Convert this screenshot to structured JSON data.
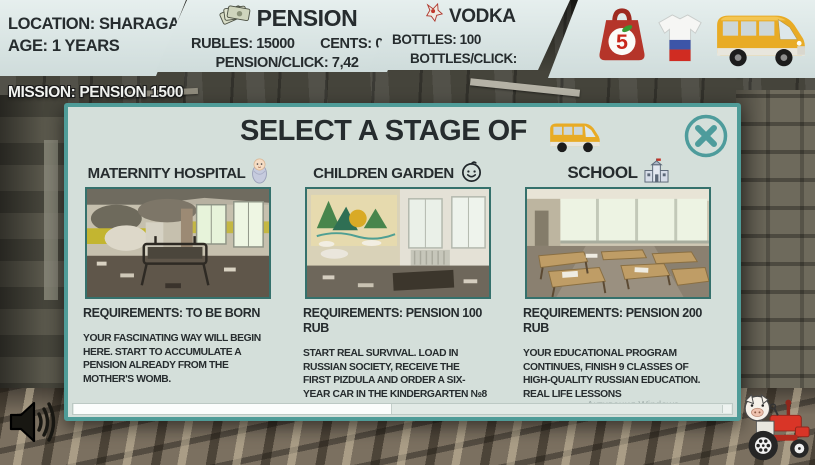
{
  "header": {
    "location": {
      "line1": "LOCATION: SHARAGA",
      "line2": "AGE: 1 YEARS"
    },
    "pension": {
      "icon": "money-fan-icon",
      "title": "PENSION",
      "rubles": "RUBLES: 15000",
      "cents": "CENTS: 0",
      "per_click": "PENSION/CLICK: 7,42"
    },
    "vodka": {
      "icon": "vodka-cap-icon",
      "title": "VODKA",
      "bottles": "BOTTLES: 100",
      "per_click": "BOTTLES/CLICK: 264210"
    },
    "shop": {
      "pyaterochka_number": "5",
      "icons": [
        "pyaterochka-bag-icon",
        "russia-flag-shirt-icon",
        "gazelle-van-icon"
      ]
    }
  },
  "mission": {
    "text": "MISSION: PENSION 1500"
  },
  "dialog": {
    "title": "SELECT A STAGE OF",
    "title_icon": "gazelle-van-icon",
    "close_icon": "close-icon",
    "stages": [
      {
        "name": "MATERNITY HOSPITAL",
        "icon": "swaddled-baby-icon",
        "photo": "abandoned-maternity-ward-photo",
        "requirements": "REQUIREMENTS: TO BE BORN",
        "description": "YOUR FASCINATING WAY WILL BEGIN HERE. START TO ACCUMULATE A PENSION ALREADY FROM THE MOTHER'S WOMB."
      },
      {
        "name": "CHILDREN GARDEN",
        "icon": "baby-face-icon",
        "photo": "abandoned-kindergarten-photo",
        "requirements": "REQUIREMENTS: PENSION 100 RUB",
        "description": "START REAL SURVIVAL. LOAD IN RUSSIAN SOCIETY, RECEIVE THE FIRST PIZDULA AND ORDER A SIX-YEAR CAR IN THE KINDERGARTEN №8"
      },
      {
        "name": "SCHOOL",
        "icon": "school-building-icon",
        "photo": "abandoned-classroom-photo",
        "requirements": "REQUIREMENTS: PENSION 200 RUB",
        "description": "YOUR EDUCATIONAL PROGRAM CONTINUES, FINISH 9 CLASSES OF HIGH-QUALITY RUSSIAN EDUCATION. REAL LIFE LESSONS"
      }
    ],
    "watermark": "Активация Windows"
  },
  "footer": {
    "icons": [
      "speaker-icon",
      "pig-tractor-icon"
    ]
  },
  "colors": {
    "panel": "#d9e4e3",
    "teal": "#4f9c98",
    "modal_bg": "#d4dfda",
    "text_dark": "#262c2e",
    "accent_red": "#b5352a",
    "van_yellow": "#e8ab25"
  }
}
